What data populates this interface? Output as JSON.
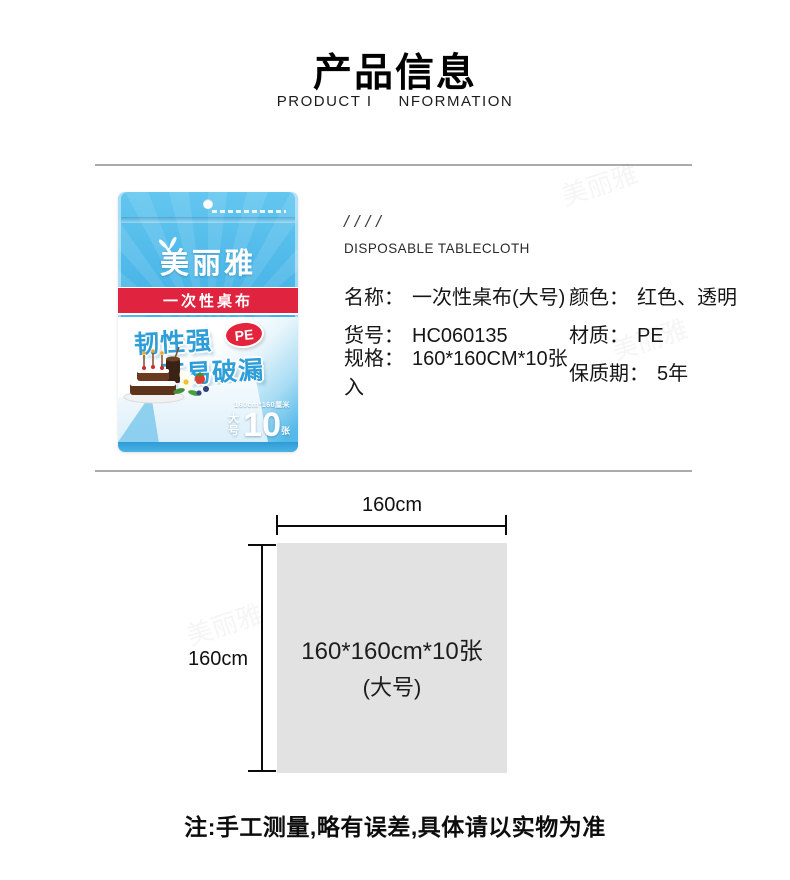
{
  "header": {
    "title": "产品信息",
    "subtitle_left": "PRODUCT I",
    "subtitle_right": "NFORMATION"
  },
  "watermark": {
    "text": "美丽雅"
  },
  "package": {
    "brand": "美丽雅",
    "band": "一次性桌布",
    "feature1": "韧性强",
    "badge": "PE",
    "feature2": "不易破漏",
    "size_note": "160cm*160厘米",
    "size_tag": "大号",
    "count": "10",
    "count_unit": "张"
  },
  "info": {
    "slashes": "////",
    "heading": "DISPOSABLE TABLECLOTH",
    "rows": [
      {
        "l_label": "名称：",
        "l_value": "一次性桌布(大号)",
        "r_label": "颜色：",
        "r_value": "红色、透明"
      },
      {
        "l_label": "货号：",
        "l_value": "HC060135",
        "r_label": "材质：",
        "r_value": "PE"
      },
      {
        "l_label": "规格：",
        "l_value": "160*160CM*10张入",
        "r_label": "保质期：",
        "r_value": "5年"
      }
    ]
  },
  "diagram": {
    "width_label": "160cm",
    "height_label": "160cm",
    "line1": "160*160cm*10张",
    "line2": "(大号)"
  },
  "footer": {
    "note": "注:手工测量,略有误差,具体请以实物为准"
  },
  "colors": {
    "package_blue": "#45b2e6",
    "band_red": "#e0243f",
    "feature_blue": "#2e9ed8",
    "badge_red": "#e3243c",
    "diagram_gray": "#e2e2e2",
    "divider_gray": "#ababab",
    "text_dark": "#161616"
  }
}
